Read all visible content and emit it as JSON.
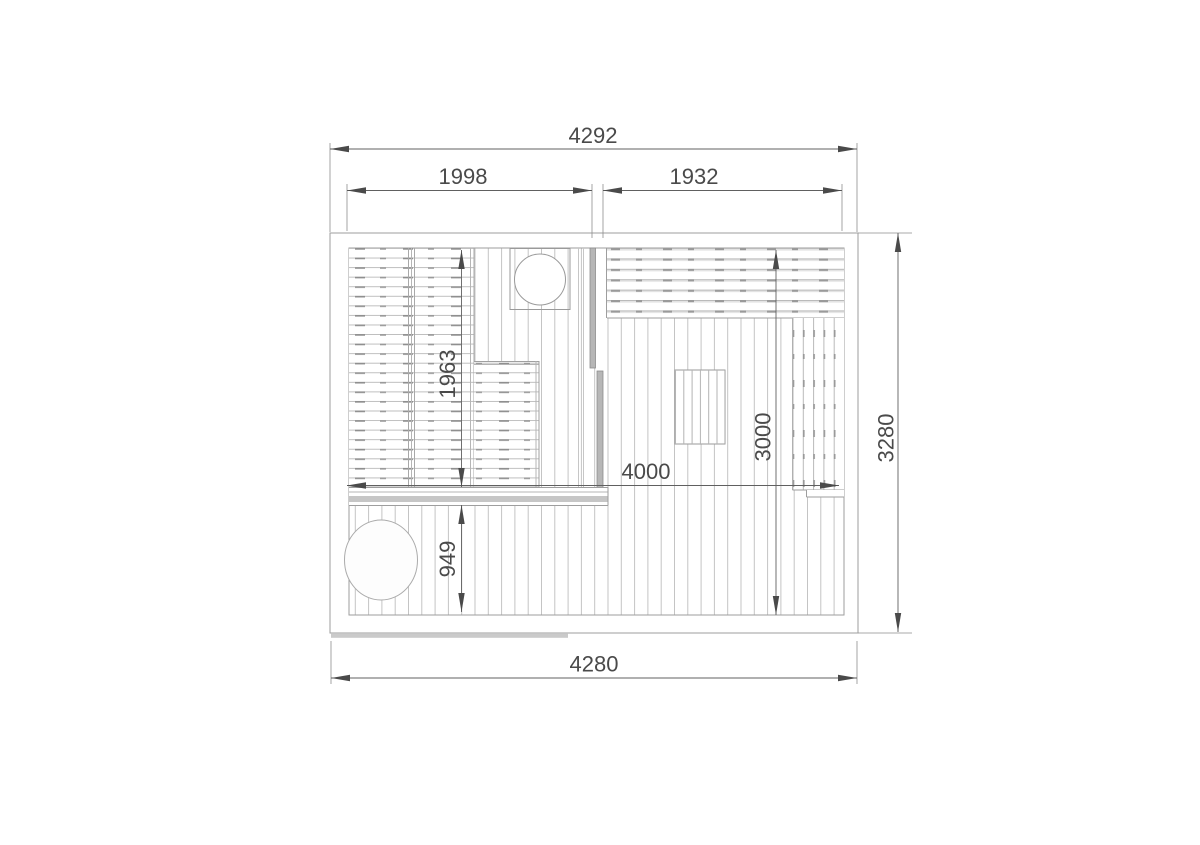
{
  "drawing": {
    "type": "floor-plan",
    "description": "sauna and terrace top-view plan with dimension lines"
  },
  "dimensions": {
    "overall_width_top": "4292",
    "left_section_width": "1998",
    "right_section_width": "1932",
    "overall_depth_right": "3280",
    "overall_width_bottom": "4280",
    "bench_length": "1963",
    "terrace_depth": "949",
    "interior_width": "4000",
    "interior_depth": "3000"
  },
  "colors": {
    "background": "#ffffff",
    "outline_gray": "#9e9e9e",
    "slat_gray": "#c2c2c2",
    "dash_gray": "#8f8f8f",
    "wall_fill": "#b6b6b6",
    "shadow_gray": "#c9c9c9",
    "dimension_gray": "#4a4a4a"
  }
}
